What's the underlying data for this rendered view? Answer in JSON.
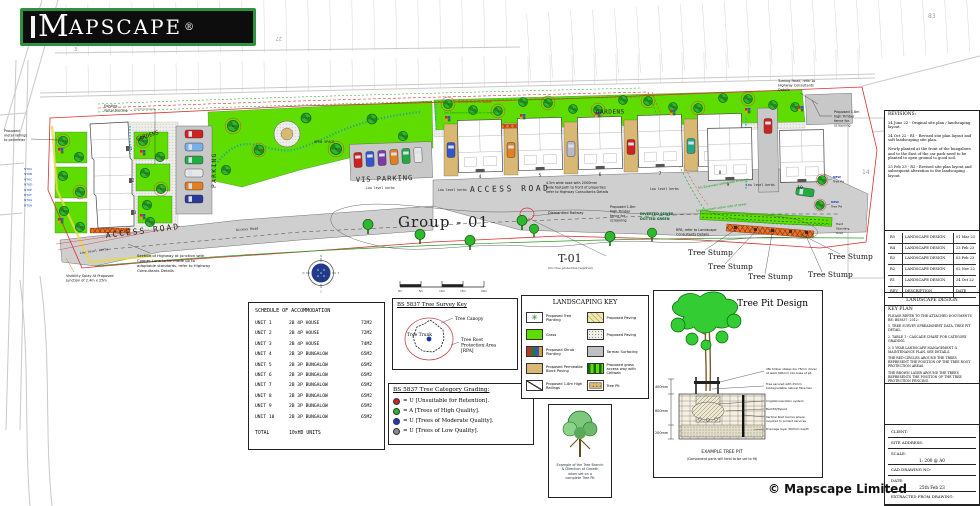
{
  "logo": {
    "text": "MAPSCAPE",
    "first": "M",
    "rest": "APSCAPE",
    "registered": "®"
  },
  "copyright": "© Mapscape Limited",
  "base_map": {
    "numbers": {
      "n3": "3",
      "n15": "15",
      "n27": "27",
      "n83": "83",
      "n14": "14"
    }
  },
  "plan": {
    "labels": {
      "group": "Group - 01",
      "t01": "T-01",
      "t01_note": "(No tree protection required)",
      "gardens": "GARDENS",
      "parking": "PARKING",
      "vis_parking": "VIS PARKING",
      "access_road": "ACCESS ROAD",
      "access_road_small": "Access Road",
      "open_space": "OPEN SPACE",
      "low_level_kerbs": "Low level kerbs",
      "house_numbers": [
        "1",
        "2",
        "3",
        "4",
        "5",
        "6",
        "7",
        "8",
        "9",
        "10"
      ],
      "tree_tags": [
        "NT6A",
        "NT6B",
        "NT6C",
        "NT6D",
        "NT6E",
        "NT6F",
        "NT6G",
        "NT6H"
      ]
    },
    "annotations": {
      "existing_fencing": [
        "Existing",
        "metal fencing"
      ],
      "proposed_railings": [
        "Proposed",
        "metal railings",
        "to perimeter"
      ],
      "timber_fence": [
        "Proposed 1.8m",
        "high Timber",
        "fence for",
        "screening"
      ],
      "highway_section": [
        "Section of Highway at Junction with",
        "Cooper Lane to be made up to",
        "adoptable standards, refer to Highway",
        "Consultants Details"
      ],
      "visibility_splay": [
        "Visibility Splay At Proposed",
        "Junction of 2.4m x 25m"
      ],
      "turning_head": [
        "Turning Head, refer to",
        "Highway Consultants",
        "Details"
      ],
      "road_note": [
        "4.5m wide road with 2000mm",
        "wide footpath to front of properties",
        "refer to Highway Consultants Details"
      ],
      "dismantled_railway": "Dismantled Railway",
      "diverted_sewer": [
        "DIVERTED SEWER",
        "DOTTED GREEN"
      ],
      "rpa_note": [
        "RPA, refer to Landscape",
        "Consultants Details"
      ],
      "tree_stump": "Tree Stump",
      "new_tree_pit": [
        "NEW",
        "Tree Pit"
      ],
      "sewer_centre": "Centre Line Of Sewer",
      "sewer_easement": "5m Easement either side of sewer",
      "hard_standing": [
        "Hard",
        "Standing",
        "Area"
      ]
    },
    "scale_bar": [
      "0m",
      "5m",
      "10m",
      "15m",
      "20m"
    ],
    "compass": {
      "n": "N",
      "e": "E",
      "s": "S",
      "w": "W"
    }
  },
  "schedule": {
    "title": "SCHEDULE OF ACCOMMODATION",
    "rows": [
      [
        "UNIT 1",
        "2B 4P HOUSE",
        "72M2"
      ],
      [
        "UNIT 2",
        "2B 4P HOUSE",
        "72M2"
      ],
      [
        "UNIT 3",
        "2B 4P HOUSE",
        "74M2"
      ],
      [
        "UNIT 4",
        "2B 3P BUNGALOW",
        "65M2"
      ],
      [
        "UNIT 5",
        "2B 3P BUNGALOW",
        "65M2"
      ],
      [
        "UNIT 6",
        "2B 3P BUNGALOW",
        "65M2"
      ],
      [
        "UNIT 7",
        "2B 3P BUNGALOW",
        "65M2"
      ],
      [
        "UNIT 8",
        "2B 3P BUNGALOW",
        "65M2"
      ],
      [
        "UNIT 9",
        "2B 3P BUNGALOW",
        "65M2"
      ],
      [
        "UNIT 10",
        "2B 3P BUNGALOW",
        "65M2"
      ]
    ],
    "total_label": "TOTAL",
    "total_value": "10xHD UNITS"
  },
  "survey_key": {
    "title": "BS 5837 Tree Survey Key",
    "canopy": "Tree Canopy",
    "trunk": "Tree Trunk",
    "rpa": [
      "Tree Root",
      "Protection Area",
      "[RPA]"
    ]
  },
  "grading": {
    "title": "BS 5837 Tree Category Grading:",
    "items": [
      {
        "color": "#cc2222",
        "label": "= U [Unsuitable for Retention]."
      },
      {
        "color": "#22bb22",
        "label": "= A [Trees of High Quality]."
      },
      {
        "color": "#2233cc",
        "label": "= U [Trees of Moderate Quality]."
      },
      {
        "color": "#8a8a8a",
        "label": "= U [Trees of Low Quality]."
      }
    ]
  },
  "landscaping_key": {
    "title": "LANDSCAPING KEY",
    "items": [
      {
        "icon": "tree-planting-swatch",
        "label": "Proposed Tree Planting"
      },
      {
        "icon": "paving-hatch-swatch",
        "label": "Proposed Paving"
      },
      {
        "icon": "grass-swatch",
        "label": "Grass"
      },
      {
        "icon": "paving-stipple-swatch",
        "label": "Proposed Paving"
      },
      {
        "icon": "shrub-planting-swatch",
        "label": "Proposed Shrub Planting"
      },
      {
        "icon": "tarmac-swatch",
        "label": "Tarmac Surfacing"
      },
      {
        "icon": "block-paving-swatch",
        "label": "Proposed Permeable Block Paving"
      },
      {
        "icon": "cellweb-swatch",
        "label": "Proposed grass access way with Cellweb"
      },
      {
        "icon": "railings-swatch",
        "label": "Proposed 1.8m High Railings"
      },
      {
        "icon": "tree-pit-swatch",
        "label": "Tree Pit"
      }
    ]
  },
  "tree_example": {
    "caption": [
      "Example of the Tree Branch",
      "& Direction of Growth",
      "when set on a",
      "complete Tree Pit"
    ]
  },
  "tree_pit": {
    "title": "Tree Pit Design",
    "dims": [
      "400mm",
      "600mm",
      "200mm"
    ],
    "annotations": [
      [
        "2№ timber stakes dia 75mm driven",
        "at least 300mm into base of pit"
      ],
      [
        "Tree secured with 25mm",
        "biodegradable natural fibre ties"
      ],
      [
        "Irrigation/aeration system"
      ],
      [
        "Backfill/Topsoil"
      ],
      [
        "Vertical Root barrier where",
        "required to protect services"
      ],
      [
        "Drainage layer 300mm depth"
      ]
    ],
    "caption": "EXAMPLE TREE PIT",
    "subcaption": "(Component parts will tend to be set to fit)"
  },
  "title_block": {
    "revisions_title": "REVISIONS:",
    "revisions": [
      "24 June 22 - Original site plan / landscaping layout.",
      "24 Oct 22 - R1 - Revised site plan layout and soft landscaping site plan.",
      "Newly planted at the front of the bungalows and to the East of the car park need to be planted to open ground to good soil.",
      "23 Feb 23 - R2 - Revised site plan layout and subsequent alteration to the landscaping layout."
    ],
    "rev_rows": [
      [
        "R5",
        "LANDSCAPE DESIGN",
        "01 Mar 23"
      ],
      [
        "R4",
        "LANDSCAPE DESIGN",
        "23 Feb 23"
      ],
      [
        "R3",
        "LANDSCAPE DESIGN",
        "03 Feb 23"
      ],
      [
        "R2",
        "LANDSCAPE DESIGN",
        "02 Nov 22"
      ],
      [
        "R1",
        "LANDSCAPE DESIGN",
        "24 Oct 22"
      ],
      [
        "REV",
        "DESCRIPTION",
        "DATE"
      ]
    ],
    "design_bar": "LANDSCAPE DESIGN",
    "key_plan": "KEY PLAN",
    "notes": [
      "PLEASE REFER TO THE ATTACHED DOCUMENTS RE: BS5837: 2012:",
      "1. TREE SURVEY SPREADSHEET DATA, TREE PIT DETAIL.",
      "2. TABLE 1 - CASCADE CHART FOR CATEGORY GRADING.",
      "3. 5 YEAR LANDSCAPE MANAGEMENT & MAINTENANCE PLAN, SEE DETAILS.",
      "THE RED CIRCLES AROUND THE TREES REPRESENT THE POSITION OF THE TREE ROOT PROTECTION AREAS.",
      "THE BROWN LAYER AROUND THE TREES REPRESENTS THE POSITION OF THE TREE PROTECTION FENCING."
    ],
    "fields": [
      {
        "label": "CLIENT:",
        "value": ""
      },
      {
        "label": "SITE ADDRESS:",
        "value": ""
      },
      {
        "label": "SCALE:",
        "value": "1: 200 @ A0"
      },
      {
        "label": "CAD DRAWING NO:",
        "value": ""
      },
      {
        "label": "DATE:",
        "value": "25th Feb 23"
      },
      {
        "label": "EXTRACTED FROM DRAWING:",
        "value": ""
      }
    ]
  }
}
